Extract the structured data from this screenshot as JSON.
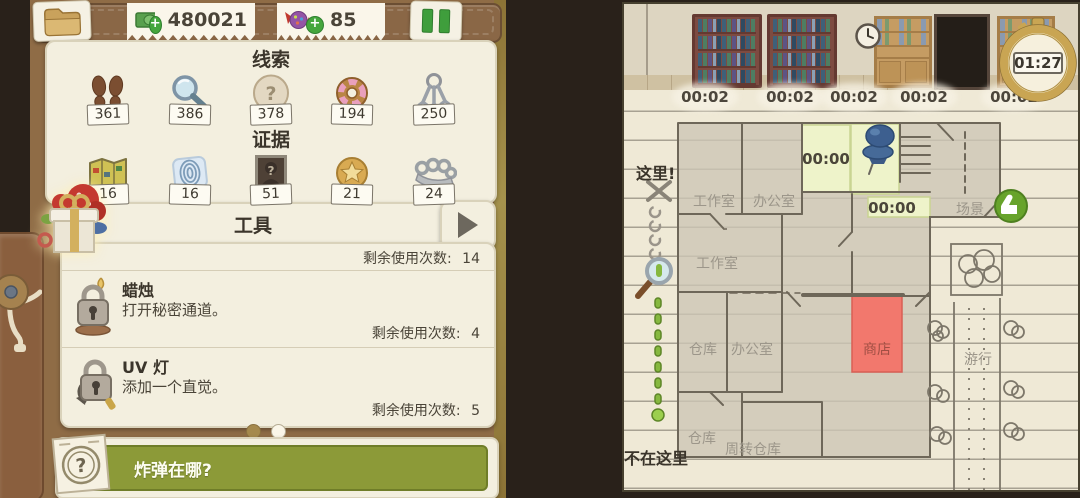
{
  "glyphs": {
    "question": "?"
  },
  "top_bar": {
    "money": "480021",
    "candy": "85"
  },
  "inventory": {
    "clues_title": "线索",
    "clues": [
      {
        "icon": "footprints",
        "count": "361"
      },
      {
        "icon": "magnifier",
        "count": "386"
      },
      {
        "icon": "stone-question",
        "count": "378"
      },
      {
        "icon": "donut",
        "count": "194"
      },
      {
        "icon": "keys",
        "count": "250"
      }
    ],
    "evidence_title": "证据",
    "evidence": [
      {
        "icon": "folded-map",
        "count": "16"
      },
      {
        "icon": "fingerprint",
        "count": "16"
      },
      {
        "icon": "suspect-photo",
        "count": "51"
      },
      {
        "icon": "badge",
        "count": "21"
      },
      {
        "icon": "brass-knuckles",
        "count": "24"
      }
    ]
  },
  "tools": {
    "title": "工具",
    "uses_label": "剩余使用次数:",
    "header_uses": "14",
    "items": [
      {
        "name": "蜡烛",
        "desc": "打开秘密通道。",
        "uses": "4"
      },
      {
        "name": "UV 灯",
        "desc": "添加一个直觉。",
        "uses": "5"
      }
    ]
  },
  "question_bar": {
    "text": "炸弹在哪?"
  },
  "map": {
    "stopwatch": "01:27",
    "scene_timers": [
      "00:02",
      "00:02",
      "00:02",
      "00:02",
      "00:02"
    ],
    "room_timer_1": "00:00",
    "room_timer_2": "00:00",
    "labels": {
      "here": "这里!",
      "not_here": "不在这里",
      "workshop_top": "工作室",
      "office_top": "办公室",
      "workshop_mid": "工作室",
      "warehouse_mid": "仓库",
      "office_mid": "办公室",
      "shop": "商店",
      "scene": "场景",
      "parade": "游行",
      "warehouse_bottom": "仓库",
      "transfer_warehouse": "周转仓库"
    }
  },
  "colors": {
    "accent_green": "#45a63d",
    "bar_green": "#8c9a38",
    "highlight_yellow": "#eef3ca",
    "highlight_red": "#f2786d",
    "paper": "#efe9d6"
  }
}
